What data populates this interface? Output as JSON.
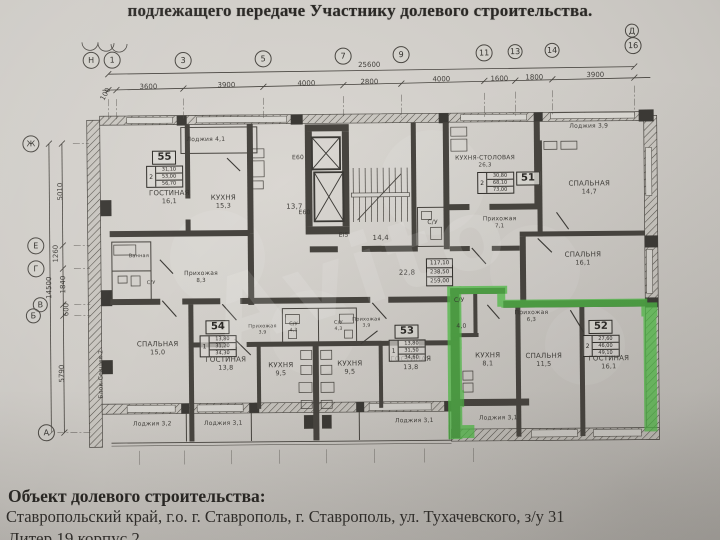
{
  "photo": {
    "header_line": "подлежащего передаче Участнику долевого строительства.",
    "watermark": "Avito"
  },
  "footer": {
    "title": "Объект долевого строительства:",
    "address": "Ставропольский край, г.о. г. Ставрополь, г. Ставрополь, ул. Тухачевского, з/у 31",
    "cut_line": "Литер 19 корпус 2"
  },
  "colors": {
    "paper": "#cfccc7",
    "ink": "#34322e",
    "highlight_green": "#4fc246"
  },
  "plan": {
    "axes": [
      {
        "label": "Н",
        "x": 93,
        "y": 58
      },
      {
        "label": "1",
        "x": 114,
        "y": 58
      },
      {
        "label": "3",
        "x": 185,
        "y": 59
      },
      {
        "label": "5",
        "x": 265,
        "y": 58
      },
      {
        "label": "7",
        "x": 345,
        "y": 56
      },
      {
        "label": "9",
        "x": 403,
        "y": 55
      },
      {
        "label": "11",
        "x": 486,
        "y": 54
      },
      {
        "label": "13",
        "x": 517,
        "y": 53,
        "r": 7.5
      },
      {
        "label": "14",
        "x": 554,
        "y": 52,
        "r": 7.5
      },
      {
        "label": "16",
        "x": 635,
        "y": 48
      },
      {
        "label": "Д",
        "x": 634,
        "y": 33,
        "r": 7
      },
      {
        "label": "Ж",
        "x": 32,
        "y": 141
      },
      {
        "label": "Е",
        "x": 36,
        "y": 243
      },
      {
        "label": "Г",
        "x": 36,
        "y": 266
      },
      {
        "label": "В",
        "x": 40,
        "y": 302,
        "r": 7.5
      },
      {
        "label": "Б",
        "x": 33,
        "y": 313,
        "r": 7.5
      },
      {
        "label": "А",
        "x": 45,
        "y": 430
      }
    ],
    "dimensions": [
      {
        "t": "25600",
        "x": 371,
        "y": 65
      },
      {
        "t": "100",
        "x": 107,
        "y": 92,
        "rot": -60
      },
      {
        "t": "3600",
        "x": 150,
        "y": 85
      },
      {
        "t": "3900",
        "x": 228,
        "y": 84
      },
      {
        "t": "4000",
        "x": 308,
        "y": 83
      },
      {
        "t": "2800",
        "x": 371,
        "y": 82
      },
      {
        "t": "4000",
        "x": 443,
        "y": 80
      },
      {
        "t": "1600",
        "x": 501,
        "y": 80
      },
      {
        "t": "1800",
        "x": 536,
        "y": 79
      },
      {
        "t": "3900",
        "x": 597,
        "y": 77
      },
      {
        "t": "14500",
        "x": 49,
        "y": 285,
        "rot": -90
      },
      {
        "t": "5010",
        "x": 61,
        "y": 189,
        "rot": -90
      },
      {
        "t": "1260",
        "x": 56,
        "y": 251,
        "rot": -90
      },
      {
        "t": "1840",
        "x": 63,
        "y": 282,
        "rot": -90
      },
      {
        "t": "600",
        "x": 66,
        "y": 307,
        "rot": -90
      },
      {
        "t": "5790",
        "x": 61,
        "y": 371,
        "rot": -90
      }
    ],
    "rooms": [
      {
        "label": "Лоджия 4,1",
        "x": 207,
        "y": 139,
        "fs": 6
      },
      {
        "label": "ГОСТИНАЯ",
        "area": "16,1",
        "x": 170,
        "y": 196
      },
      {
        "label": "КУХНЯ",
        "area": "15,3",
        "x": 224,
        "y": 201
      },
      {
        "label": "КУХНЯ-СТОЛОВАЯ",
        "area": "26,3",
        "x": 486,
        "y": 163,
        "fs": 6
      },
      {
        "label": "Лоджия 3,9",
        "x": 590,
        "y": 129,
        "fs": 6
      },
      {
        "label": "СПАЛЬНАЯ",
        "area": "14,7",
        "x": 590,
        "y": 190
      },
      {
        "label": "Прихожая",
        "area": "7,1",
        "x": 500,
        "y": 224,
        "fs": 6
      },
      {
        "label": "С/У",
        "x": 433,
        "y": 224,
        "fs": 6
      },
      {
        "label": "13,7",
        "x": 295,
        "y": 207
      },
      {
        "label": "14,4",
        "x": 381,
        "y": 239
      },
      {
        "label": "Е60",
        "x": 299,
        "y": 158,
        "fs": 6
      },
      {
        "label": "Е60",
        "x": 305,
        "y": 213,
        "fs": 6
      },
      {
        "label": "ЕI5",
        "x": 344,
        "y": 236,
        "fs": 6
      },
      {
        "label": "22,8",
        "x": 407,
        "y": 274
      },
      {
        "label": "Прихожая",
        "area": "8,3",
        "x": 201,
        "y": 276,
        "fs": 6
      },
      {
        "label": "Ванная",
        "x": 139,
        "y": 255,
        "fs": 5
      },
      {
        "label": "С/У",
        "x": 151,
        "y": 282,
        "fs": 5
      },
      {
        "label": "СПАЛЬНАЯ",
        "area": "15,0",
        "x": 157,
        "y": 347
      },
      {
        "label": "ГОСТИНАЯ",
        "area": "13,8",
        "x": 225,
        "y": 363
      },
      {
        "label": "КУХНЯ",
        "area": "9,5",
        "x": 280,
        "y": 369
      },
      {
        "label": "КУХНЯ",
        "area": "9,5",
        "x": 349,
        "y": 368
      },
      {
        "label": "ГОСТИНАЯ",
        "area": "13,8",
        "x": 410,
        "y": 364
      },
      {
        "label": "С/У",
        "area": "4,3",
        "x": 293,
        "y": 327,
        "fs": 5
      },
      {
        "label": "С/У",
        "area": "4,3",
        "x": 338,
        "y": 326,
        "fs": 5
      },
      {
        "label": "Прихожая",
        "area": "3,9",
        "x": 262,
        "y": 329,
        "fs": 5
      },
      {
        "label": "Прихожая",
        "area": "3,9",
        "x": 366,
        "y": 323,
        "fs": 5
      },
      {
        "label": "Лоджия 3,2",
        "x": 151,
        "y": 423,
        "fs": 6
      },
      {
        "label": "Лоджия 3,1",
        "x": 222,
        "y": 423,
        "fs": 6
      },
      {
        "label": "Лоджия 3,1",
        "x": 413,
        "y": 422,
        "fs": 6
      },
      {
        "label": "Лоджия 3,1",
        "x": 497,
        "y": 420,
        "fs": 6
      },
      {
        "label": "С/У",
        "x": 459,
        "y": 302,
        "fs": 6
      },
      {
        "label": "4,0",
        "x": 461,
        "y": 328,
        "fs": 6
      },
      {
        "label": "Прихожая",
        "area": "6,3",
        "x": 531,
        "y": 318,
        "fs": 6
      },
      {
        "label": "КУХНЯ",
        "area": "8,1",
        "x": 487,
        "y": 361
      },
      {
        "label": "СПАЛЬНЯ",
        "area": "11,5",
        "x": 543,
        "y": 362
      },
      {
        "label": "ГОСТИНАЯ",
        "area": "16,1",
        "x": 608,
        "y": 365
      },
      {
        "label": "СПАЛЬНЯ",
        "area": "16,1",
        "x": 583,
        "y": 261
      },
      {
        "label": "Блок-Секция 2",
        "x": 101,
        "y": 372,
        "fs": 6,
        "rot": -90
      }
    ],
    "stamps": [
      {
        "num": "55",
        "rooms": "2",
        "areas": [
          "31,10",
          "53,00",
          "56,70"
        ],
        "x": 147,
        "y": 149
      },
      {
        "num": "51",
        "rooms": "2",
        "areas": [
          "30,80",
          "68,10",
          "73,00"
        ],
        "x": 478,
        "y": 173,
        "num_pos": "right"
      },
      {
        "num": "54",
        "rooms": "1",
        "areas": [
          "13,80",
          "31,20",
          "34,30"
        ],
        "x": 199,
        "y": 319
      },
      {
        "num": "53",
        "rooms": "1",
        "areas": [
          "13,80",
          "31,50",
          "34,60"
        ],
        "x": 388,
        "y": 325
      },
      {
        "num": "52",
        "rooms": "2",
        "areas": [
          "27,60",
          "46,00",
          "49,10"
        ],
        "x": 582,
        "y": 322
      }
    ],
    "floor_totals": {
      "x": 426,
      "y": 259,
      "values": [
        "117,10",
        "238,50",
        "259,00"
      ]
    }
  }
}
